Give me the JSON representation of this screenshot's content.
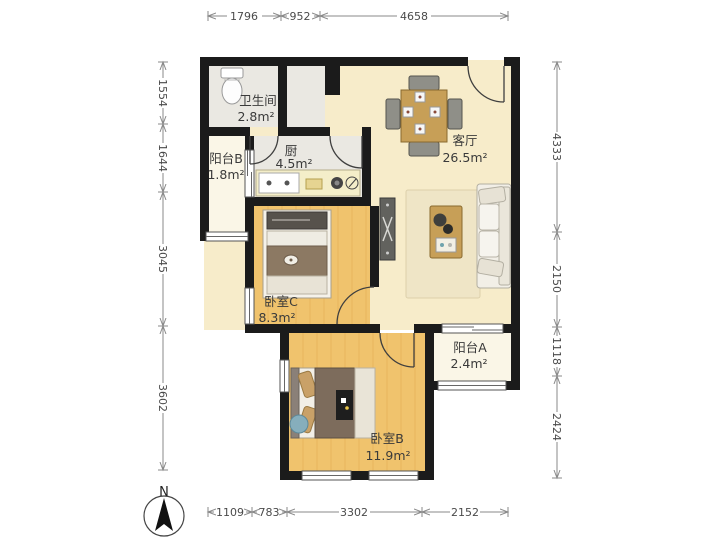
{
  "rooms": [
    {
      "name": "卫生间",
      "area": "2.8m²"
    },
    {
      "name": "阳台B",
      "area": "1.8m²"
    },
    {
      "name": "厨",
      "area": "4.5m²"
    },
    {
      "name": "客厅",
      "area": "26.5m²"
    },
    {
      "name": "卧室C",
      "area": "8.3m²"
    },
    {
      "name": "阳台A",
      "area": "2.4m²"
    },
    {
      "name": "卧室B",
      "area": "11.9m²"
    }
  ],
  "dimensions_mm": {
    "top": [
      "1796",
      "952",
      "4658"
    ],
    "bottom": [
      "1109",
      "783",
      "3302",
      "2152"
    ],
    "left": [
      "1554",
      "1644",
      "3045",
      "3602"
    ],
    "right": [
      "4333",
      "2150",
      "1118",
      "2424"
    ]
  },
  "compass": {
    "label": "N"
  },
  "colors": {
    "wall": "#1b1b1b",
    "living_floor": "#f7ecca",
    "bedroom_floor": "#f0c36d",
    "tile_floor": "#eae8e2",
    "balcony_floor": "#faf6e7",
    "wood_accent": "#c79f57",
    "dim_line": "#8a8a8a"
  }
}
